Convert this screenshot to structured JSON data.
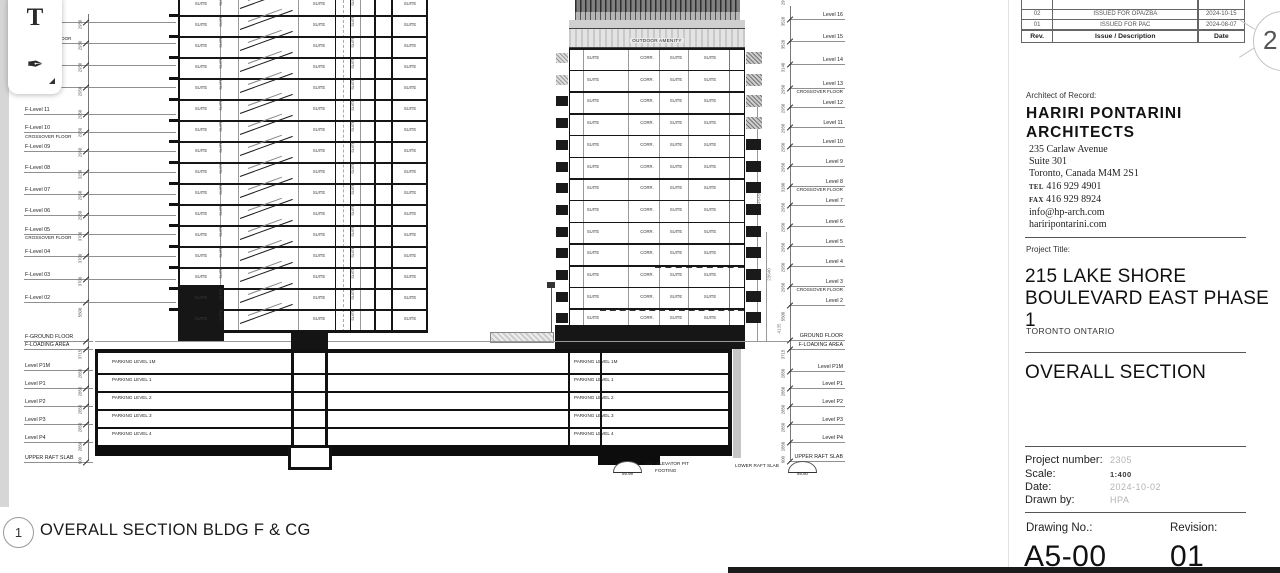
{
  "toolbar": {
    "text_tool_glyph": "T",
    "pen_tool_glyph": "✒"
  },
  "caption": {
    "number": "1",
    "text": "OVERALL SECTION BLDG F & CG"
  },
  "sheet_ref": {
    "number": "2"
  },
  "revision_table": {
    "headers": [
      "Rev.",
      "Issue / Description",
      "Date"
    ],
    "rows": [
      [
        "02",
        "ISSUED FOR OPA/ZBA",
        "2024-10-15"
      ],
      [
        "01",
        "ISSUED FOR PAC",
        "2024-08-07"
      ]
    ]
  },
  "architect": {
    "label": "Architect of Record:",
    "name_line1": "HARIRI PONTARINI",
    "name_line2": "ARCHITECTS",
    "address": [
      "235 Carlaw Avenue",
      "Suite 301",
      "Toronto, Canada  M4M 2S1"
    ],
    "tel_label": "TEL",
    "tel": "416 929 4901",
    "fax_label": "FAX",
    "fax": "416 929 8924",
    "email": "info@hp-arch.com",
    "website": "hariripontarini.com"
  },
  "project": {
    "label": "Project Title:",
    "title_line1": "215 LAKE SHORE",
    "title_line2": "BOULEVARD EAST PHASE 1",
    "location": "TORONTO ONTARIO",
    "sheet_title": "OVERALL SECTION"
  },
  "meta": {
    "project_number_label": "Project number:",
    "project_number": "2305",
    "scale_label": "Scale:",
    "scale": "1:400",
    "date_label": "Date:",
    "date": "2024-10-02",
    "drawn_label": "Drawn by:",
    "drawn": "HPA",
    "drawing_no_label": "Drawing No.:",
    "drawing_no": "A5-00",
    "revision_label": "Revision:",
    "revision": "01"
  },
  "drawing": {
    "suite_label": "SUITE",
    "corr_label": "CORR.",
    "outdoor_amenity": "OUTDOOR AMENITY",
    "parking_labels": [
      "PARKING LEVEL 1M",
      "PARKING LEVEL 1",
      "PARKING LEVEL 2",
      "PARKING LEVEL 3",
      "PARKING LEVEL 4"
    ],
    "left_levels": [
      {
        "y": 19,
        "label": "",
        "t": "lvl"
      },
      {
        "y": 40,
        "label": "CROSSOVER FLOOR",
        "t": "lvl"
      },
      {
        "y": 62,
        "label": "",
        "t": "lvl"
      },
      {
        "y": 84,
        "label": "",
        "t": "lvl"
      },
      {
        "y": 111,
        "label": "F-Level 11",
        "t": "lvl"
      },
      {
        "y": 129,
        "label": "F-Level 10",
        "t": "lvl"
      },
      {
        "y": 138,
        "label": "CROSSOVER FLOOR",
        "t": "note"
      },
      {
        "y": 148,
        "label": "F-Level 09",
        "t": "lvl"
      },
      {
        "y": 169,
        "label": "F-Level 08",
        "t": "lvl"
      },
      {
        "y": 191,
        "label": "F-Level 07",
        "t": "lvl"
      },
      {
        "y": 212,
        "label": "F-Level 06",
        "t": "lvl"
      },
      {
        "y": 231,
        "label": "F-Level 05",
        "t": "lvl"
      },
      {
        "y": 239,
        "label": "CROSSOVER FLOOR",
        "t": "note"
      },
      {
        "y": 253,
        "label": "F-Level 04",
        "t": "lvl"
      },
      {
        "y": 276,
        "label": "F-Level 03",
        "t": "lvl"
      },
      {
        "y": 299,
        "label": "F-Level 02",
        "t": "lvl"
      },
      {
        "y": 338,
        "label": "F-GROUND FLOOR",
        "t": "lvl"
      },
      {
        "y": 346,
        "label": "F-LOADING AREA",
        "t": "lvl"
      },
      {
        "y": 367,
        "label": "Level P1M",
        "t": "lvl"
      },
      {
        "y": 385,
        "label": "Level P1",
        "t": "lvl"
      },
      {
        "y": 403,
        "label": "Level P2",
        "t": "lvl"
      },
      {
        "y": 421,
        "label": "Level P3",
        "t": "lvl"
      },
      {
        "y": 439,
        "label": "Level P4",
        "t": "lvl"
      },
      {
        "y": 459,
        "label": "UPPER RAFT SLAB",
        "t": "lvl"
      }
    ],
    "right_levels": [
      {
        "y": 16,
        "label": "Level 16",
        "t": "lvl"
      },
      {
        "y": 38,
        "label": "Level 15",
        "t": "lvl"
      },
      {
        "y": 61,
        "label": "Level 14",
        "t": "lvl"
      },
      {
        "y": 85,
        "label": "Level 13",
        "t": "lvl"
      },
      {
        "y": 93,
        "label": "CROSSOVER FLOOR",
        "t": "note"
      },
      {
        "y": 104,
        "label": "Level 12",
        "t": "lvl"
      },
      {
        "y": 124,
        "label": "Level 11",
        "t": "lvl"
      },
      {
        "y": 143,
        "label": "Level 10",
        "t": "lvl"
      },
      {
        "y": 163,
        "label": "Level 9",
        "t": "lvl"
      },
      {
        "y": 183,
        "label": "Level 8",
        "t": "lvl"
      },
      {
        "y": 191,
        "label": "CROSSOVER FLOOR",
        "t": "note"
      },
      {
        "y": 202,
        "label": "Level 7",
        "t": "lvl"
      },
      {
        "y": 223,
        "label": "Level 6",
        "t": "lvl"
      },
      {
        "y": 243,
        "label": "Level 5",
        "t": "lvl"
      },
      {
        "y": 263,
        "label": "Level 4",
        "t": "lvl"
      },
      {
        "y": 283,
        "label": "Level 3",
        "t": "lvl"
      },
      {
        "y": 291,
        "label": "CROSSOVER FLOOR",
        "t": "note"
      },
      {
        "y": 302,
        "label": "Level 2",
        "t": "lvl"
      },
      {
        "y": 337,
        "label": "GROUND FLOOR",
        "t": "lvl"
      },
      {
        "y": 346,
        "label": "F-LOADING AREA",
        "t": "lvl"
      },
      {
        "y": 368,
        "label": "Level P1M",
        "t": "lvl"
      },
      {
        "y": 385,
        "label": "Level P1",
        "t": "lvl"
      },
      {
        "y": 403,
        "label": "Level P2",
        "t": "lvl"
      },
      {
        "y": 421,
        "label": "Level P3",
        "t": "lvl"
      },
      {
        "y": 439,
        "label": "Level P4",
        "t": "lvl"
      },
      {
        "y": 458,
        "label": "UPPER RAFT SLAB",
        "t": "lvl"
      }
    ],
    "left_dims": [
      {
        "y": 30,
        "v": "2950"
      },
      {
        "y": 51,
        "v": "2950"
      },
      {
        "y": 73,
        "v": "2950"
      },
      {
        "y": 97,
        "v": "2950"
      },
      {
        "y": 120,
        "v": "2950"
      },
      {
        "y": 138,
        "v": "2950"
      },
      {
        "y": 158,
        "v": "2950"
      },
      {
        "y": 180,
        "v": "3250"
      },
      {
        "y": 201,
        "v": "2950"
      },
      {
        "y": 221,
        "v": "2950"
      },
      {
        "y": 242,
        "v": "3700"
      },
      {
        "y": 264,
        "v": "3700"
      },
      {
        "y": 287,
        "v": "3700"
      },
      {
        "y": 318,
        "v": "5500"
      },
      {
        "y": 360,
        "v": "3715"
      },
      {
        "y": 379,
        "v": "2850"
      },
      {
        "y": 397,
        "v": "2850"
      },
      {
        "y": 415,
        "v": "2850"
      },
      {
        "y": 433,
        "v": "2850"
      },
      {
        "y": 452,
        "v": "2850"
      },
      {
        "y": 466,
        "v": "600"
      }
    ],
    "right_dims": [
      {
        "y": 6,
        "v": "2950"
      },
      {
        "y": 27,
        "v": "3520"
      },
      {
        "y": 50,
        "v": "3520"
      },
      {
        "y": 73,
        "v": "3140"
      },
      {
        "y": 95,
        "v": "2950"
      },
      {
        "y": 114,
        "v": "2950"
      },
      {
        "y": 134,
        "v": "2950"
      },
      {
        "y": 153,
        "v": "2950"
      },
      {
        "y": 173,
        "v": "2950"
      },
      {
        "y": 193,
        "v": "3180"
      },
      {
        "y": 213,
        "v": "2950"
      },
      {
        "y": 233,
        "v": "2950"
      },
      {
        "y": 253,
        "v": "2950"
      },
      {
        "y": 273,
        "v": "2950"
      },
      {
        "y": 293,
        "v": "2950"
      },
      {
        "y": 322,
        "v": "5500"
      },
      {
        "y": 360,
        "v": "3715"
      },
      {
        "y": 379,
        "v": "2850"
      },
      {
        "y": 397,
        "v": "2850"
      },
      {
        "y": 415,
        "v": "2850"
      },
      {
        "y": 433,
        "v": "2850"
      },
      {
        "y": 452,
        "v": "2850"
      },
      {
        "y": 465,
        "v": "600"
      }
    ],
    "totals": [
      {
        "x": 747,
        "y": 195,
        "v": "45450"
      },
      {
        "x": 757,
        "y": 272,
        "v": "23640"
      },
      {
        "x": 767,
        "y": 326,
        "v": "4135"
      }
    ],
    "annotations": {
      "pit_elev": "56.99",
      "pit_line1": "CG - ELEVATOR PIT",
      "pit_line2": "FOOTING",
      "lower_raft": "LOWER RAFT SLAB",
      "lower_raft_elev": "56.80"
    }
  }
}
